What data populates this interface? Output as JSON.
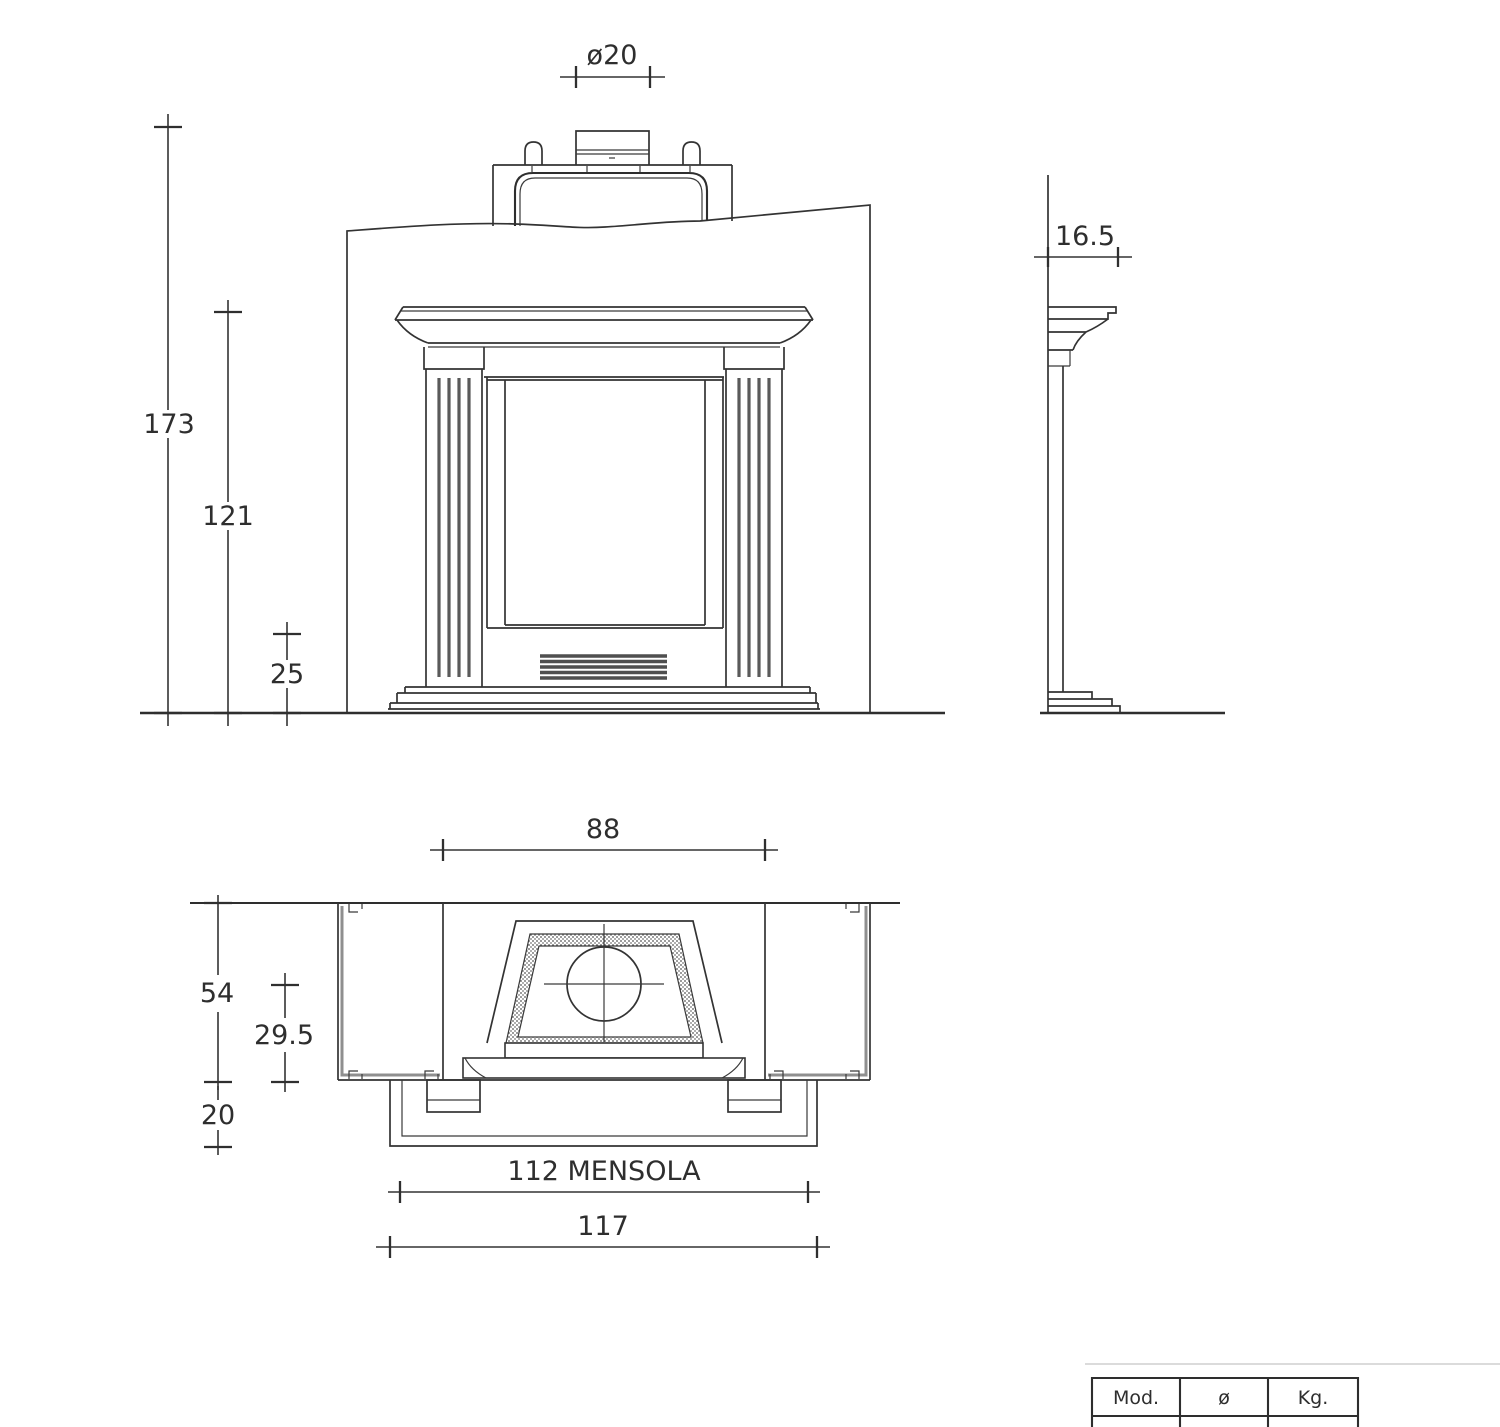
{
  "background": "#ffffff",
  "line_color": "#333333",
  "text_color": "#2e2e2e",
  "dimensions": {
    "flue_diameter": "ø20",
    "overall_height": "173",
    "mantel_height": "121",
    "hearth_height": "25",
    "side_overhang": "16.5",
    "opening_width": "88",
    "overall_depth": "54",
    "flue_center_depth": "29.5",
    "base_depth": "20",
    "shelf_width": "112 MENSOLA",
    "overall_width": "117"
  },
  "spec_table": {
    "headers": [
      "Mod.",
      "ø",
      "Kg."
    ]
  }
}
